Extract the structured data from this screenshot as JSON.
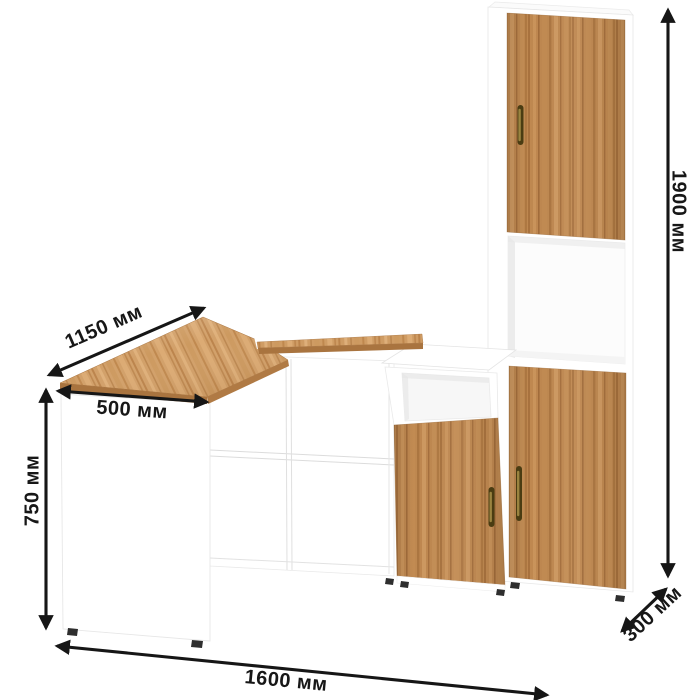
{
  "product": {
    "name": "corner-desk-with-tall-cabinet",
    "unit": "мм",
    "colors": {
      "body": "#ffffff",
      "wood_base": "#bf8850",
      "wood_dark": "#a06a38",
      "wood_light": "#d09c63",
      "desk_wood": "#d2a069",
      "handle": "#8f7b35",
      "arrow": "#161616",
      "edge": "#e7e7e7"
    }
  },
  "dimensions": {
    "desk_depth": {
      "label": "1150 мм"
    },
    "desk_front_width": {
      "label": "500 мм"
    },
    "desk_height": {
      "label": "750 мм"
    },
    "total_width": {
      "label": "1600 мм"
    },
    "unit_depth": {
      "label": "300 мм"
    },
    "total_height": {
      "label": "1900 мм"
    }
  }
}
